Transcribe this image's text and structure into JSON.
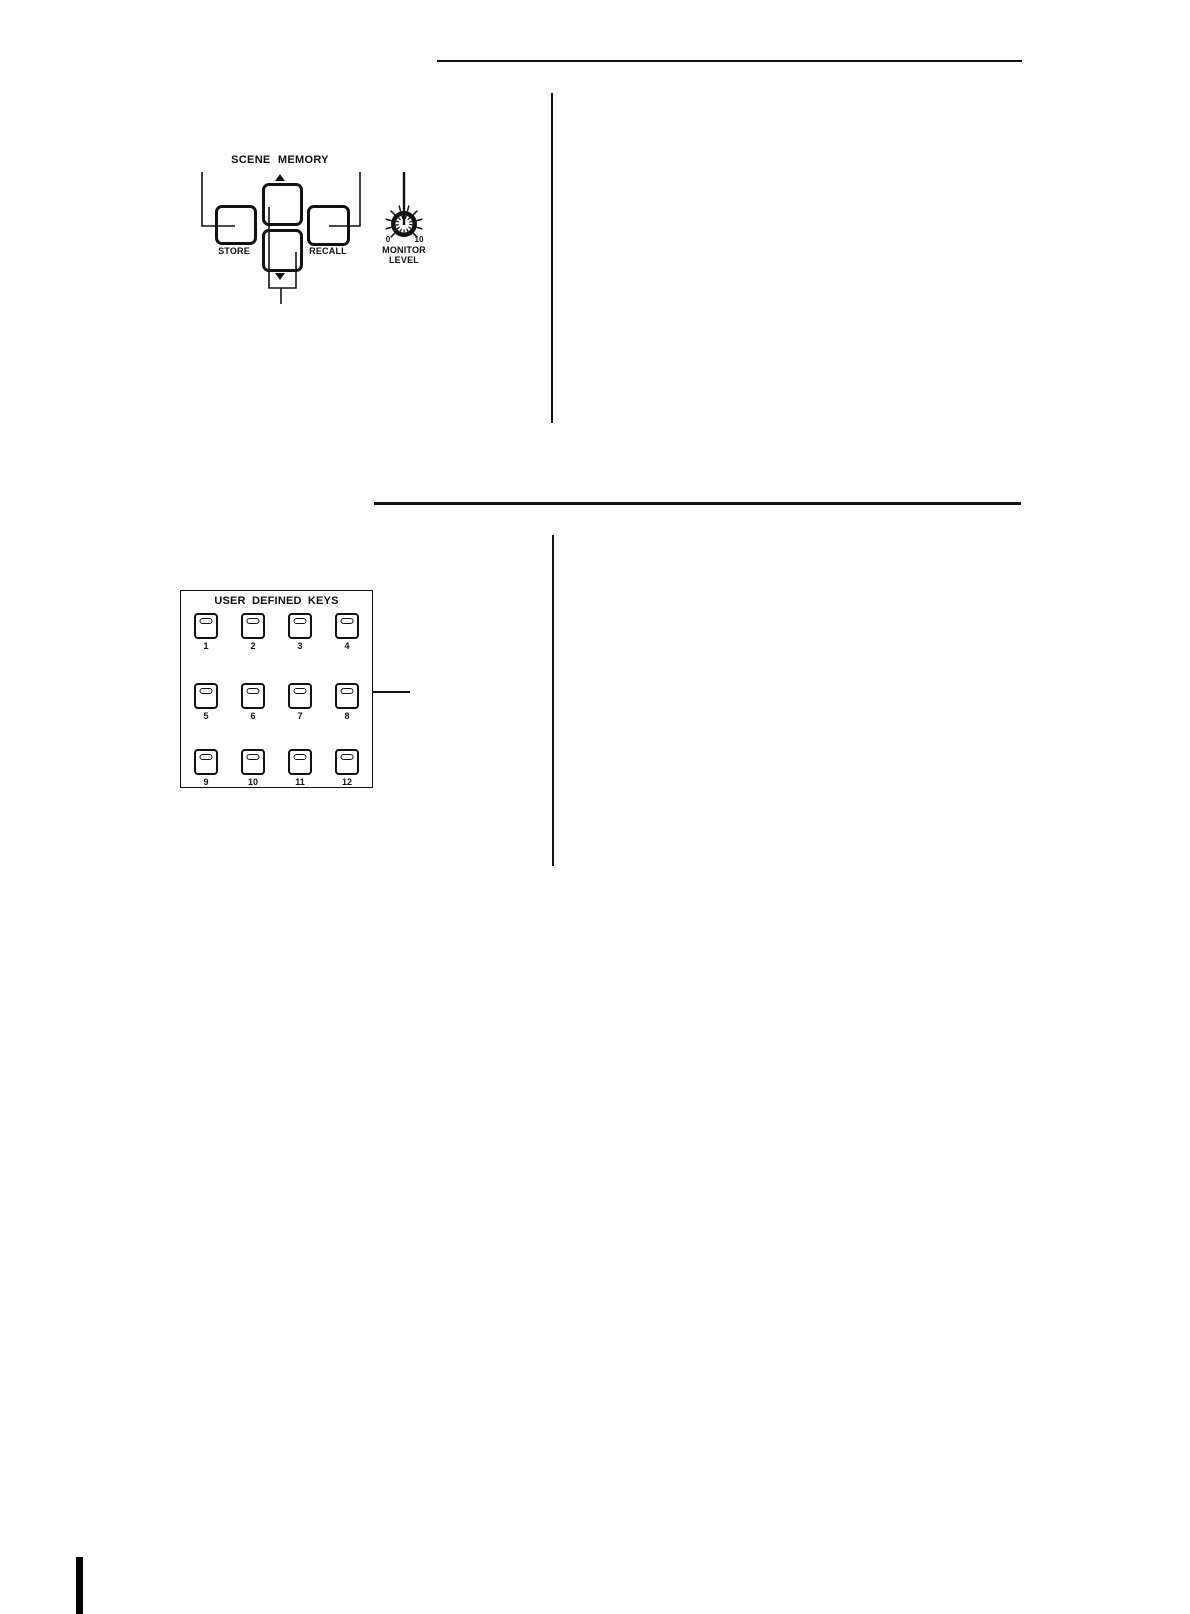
{
  "colors": {
    "ink": "#111111",
    "paper": "#ffffff"
  },
  "scene_memory": {
    "title": "SCENE MEMORY",
    "store_label": "STORE",
    "recall_label": "RECALL",
    "monitor_level": {
      "min": "0",
      "max": "10",
      "name_line1": "MONITOR",
      "name_line2": "LEVEL"
    }
  },
  "user_defined_keys": {
    "title": "USER DEFINED KEYS",
    "keys": [
      {
        "number": "1"
      },
      {
        "number": "2"
      },
      {
        "number": "3"
      },
      {
        "number": "4"
      },
      {
        "number": "5"
      },
      {
        "number": "6"
      },
      {
        "number": "7"
      },
      {
        "number": "8"
      },
      {
        "number": "9"
      },
      {
        "number": "10"
      },
      {
        "number": "11"
      },
      {
        "number": "12"
      }
    ]
  }
}
